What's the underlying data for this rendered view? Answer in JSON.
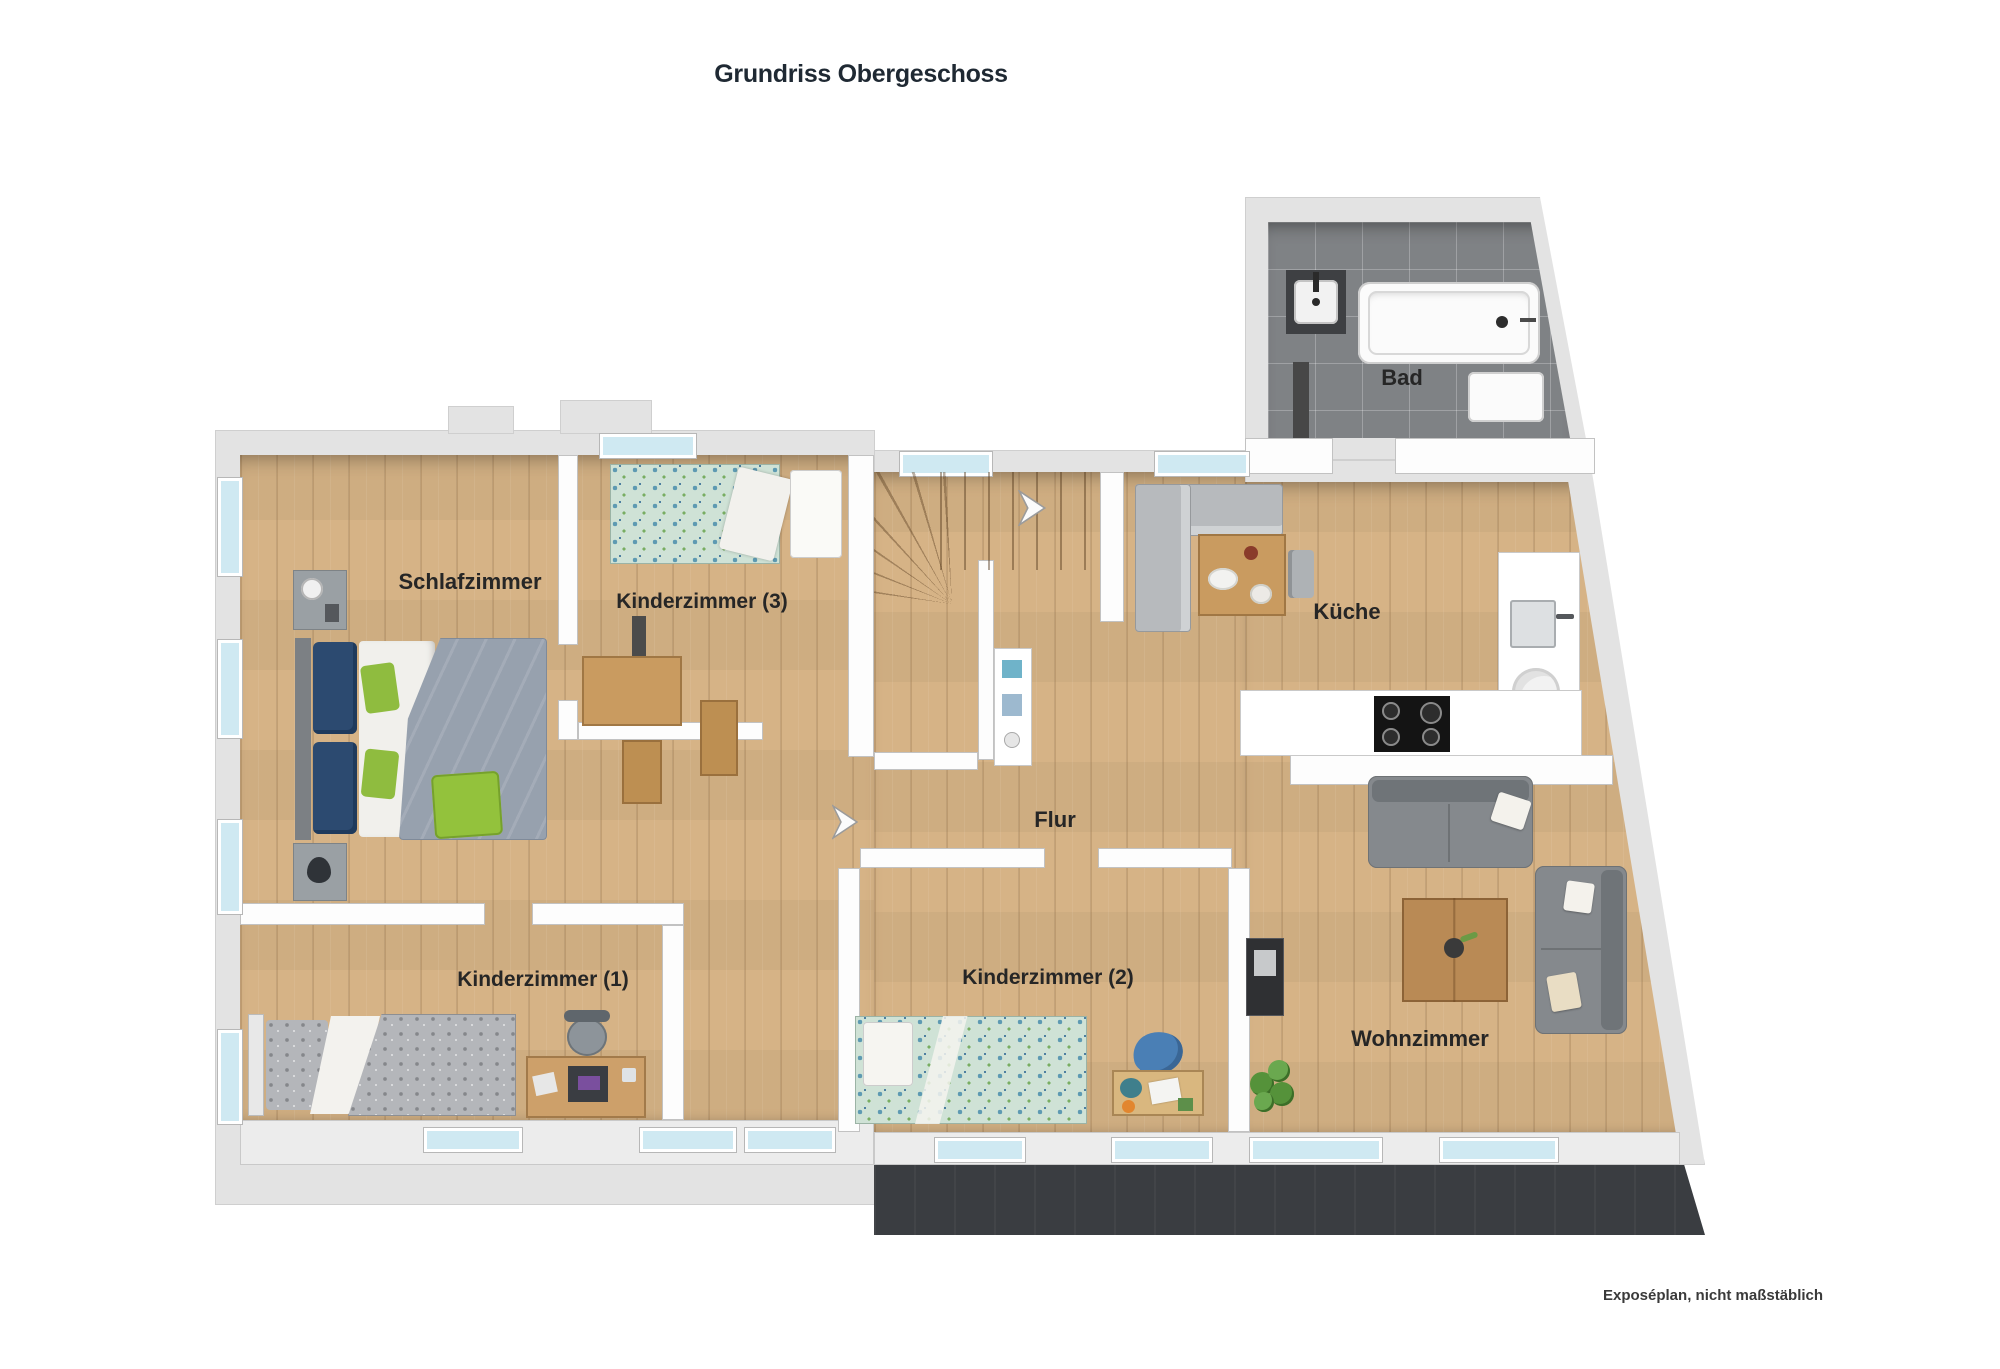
{
  "title": {
    "text": "Grundriss Obergeschoss"
  },
  "footnote": {
    "text": "Exposéplan, nicht maßstäblich"
  },
  "watermark": {
    "text": "GrundrissGrafik"
  },
  "rooms": [
    {
      "id": "schlafzimmer",
      "label": "Schlafzimmer"
    },
    {
      "id": "kinderzimmer-3",
      "label": "Kinderzimmer (3)"
    },
    {
      "id": "kinderzimmer-1",
      "label": "Kinderzimmer (1)"
    },
    {
      "id": "kinderzimmer-2",
      "label": "Kinderzimmer (2)"
    },
    {
      "id": "flur",
      "label": "Flur"
    },
    {
      "id": "kueche",
      "label": "Küche"
    },
    {
      "id": "bad",
      "label": "Bad"
    },
    {
      "id": "wohnzimmer",
      "label": "Wohnzimmer"
    }
  ],
  "colors": {
    "wood_floor": "#d6b386",
    "wall_outer": "#e3e3e3",
    "wall_inner": "#ffffff",
    "bath_tile": "#7f8285",
    "terrace": "#3a3d41",
    "window_glass": "#cfe9f2",
    "bed_blue": "#2c4a70",
    "accent_green": "#93c23c",
    "sofa_gray": "#85898d",
    "label_text": "#262626"
  }
}
